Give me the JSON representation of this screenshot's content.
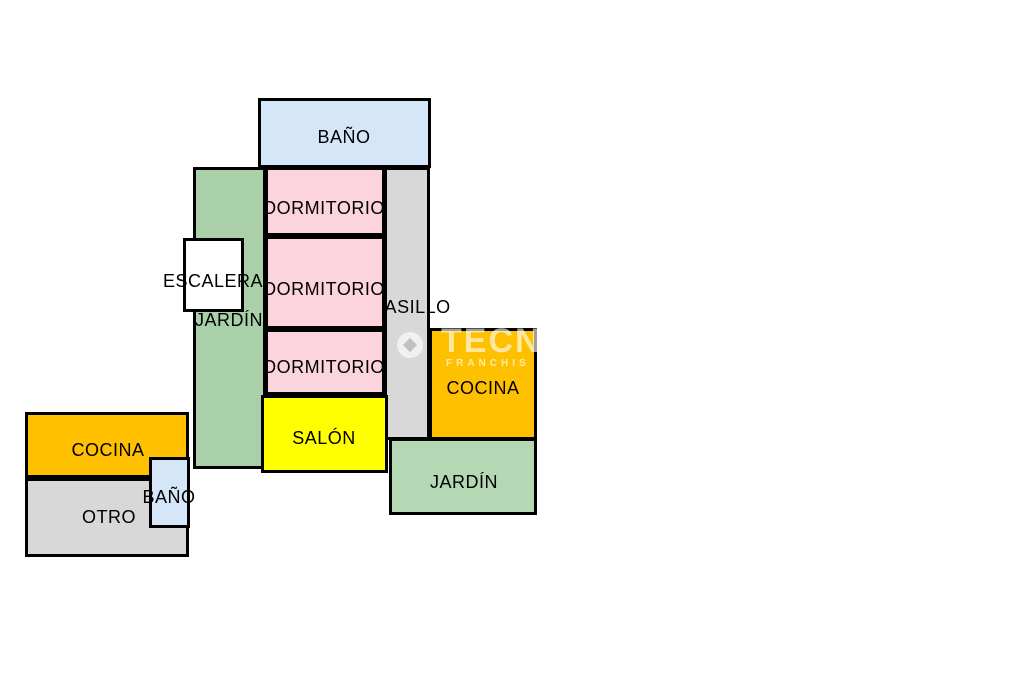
{
  "plan_title": "floor-plan",
  "colors": {
    "background": "#ffffff",
    "border": "#000000",
    "label_text": "#000000",
    "bath": "#d4e6f8",
    "bedroom": "#fbd4dd",
    "garden_left": "#a9d0a9",
    "garden_right": "#b4d8b4",
    "hallway": "#d8d8d8",
    "kitchen": "#ffc000",
    "living_room": "#ffff00",
    "other": "#d8d8d8",
    "stairs": "#ffffff"
  },
  "rooms": {
    "bath_top": {
      "label": "BAÑO"
    },
    "garden_left": {
      "label": "JARDÍN"
    },
    "hallway": {
      "label": "PASILLO"
    },
    "bedroom_1": {
      "label": "DORMITORIO"
    },
    "bedroom_2": {
      "label": "DORMITORIO"
    },
    "bedroom_3": {
      "label": "DORMITORIO"
    },
    "stairs": {
      "label": "ESCALERA"
    },
    "kitchen_right": {
      "label": "COCINA"
    },
    "living_room": {
      "label": "SALÓN"
    },
    "garden_right": {
      "label": "JARDÍN"
    },
    "kitchen_left": {
      "label": "COCINA"
    },
    "other": {
      "label": "OTRO"
    },
    "bath_small": {
      "label": "BAÑO"
    }
  },
  "watermark": {
    "line1": "TECN",
    "line2": "FRANCHIS",
    "icon": "circle-logo-icon"
  }
}
